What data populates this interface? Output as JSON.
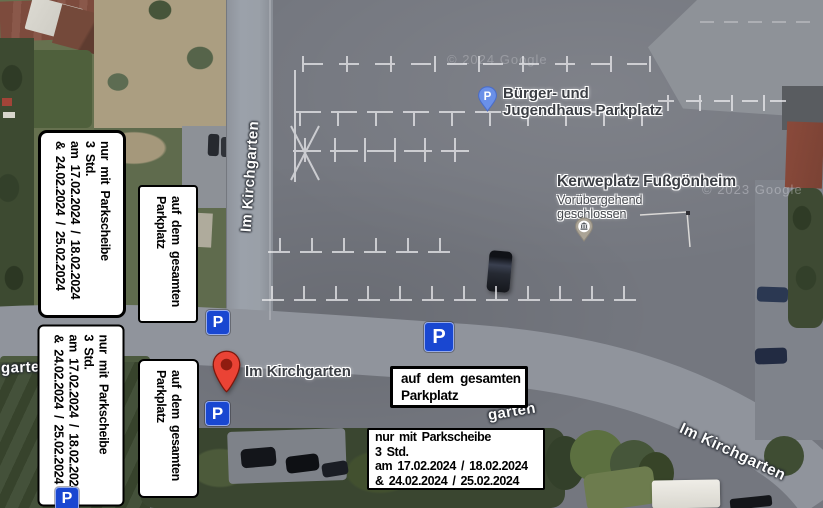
{
  "annotations": {
    "parkscheibe": {
      "line1": "nur mit Parkscheibe",
      "line2": "3 Std.",
      "line3": "am 17.02.2024 / 18.02.2024",
      "line4": "& 24.02.2024 / 25.02.2024"
    },
    "parkplatz": {
      "line1": "auf dem gesamten",
      "line2": "Parkplatz"
    },
    "parking_sign_letter": "P"
  },
  "map": {
    "poi": {
      "buerger_jugendhaus": {
        "line1": "Bürger- und",
        "line2": "Jugendhaus Parkplatz",
        "pin_letter": "P"
      },
      "kerweplatz": {
        "title": "Kerweplatz Fußgönheim",
        "status_line1": "Vorübergehend",
        "status_line2": "geschlossen"
      },
      "kirchgarten_marker": {
        "label": "Im Kirchgarten"
      }
    },
    "streets": {
      "kirchgarten_vertical": "Im Kirchgarten",
      "kirchgarten_left_fragment": "garten",
      "kirchgarten_center_fragment": "garten",
      "kirchgarten_bottom_right": "Im Kirchgarten"
    },
    "watermarks": {
      "top": "© 2024 Google",
      "right": "© 2023 Google"
    }
  },
  "colors": {
    "sign_blue": "#1947d1",
    "pin_red": "#ea4335",
    "pin_red_dot": "#8f1c10",
    "parking_pin_blue": "#6a90e8",
    "closed_pin_gray": "#aba496",
    "street_label_text": "#fdfdfd",
    "poi_label_text": "#3b3e44",
    "box_bg": "#ffffff",
    "box_border": "#000000"
  }
}
